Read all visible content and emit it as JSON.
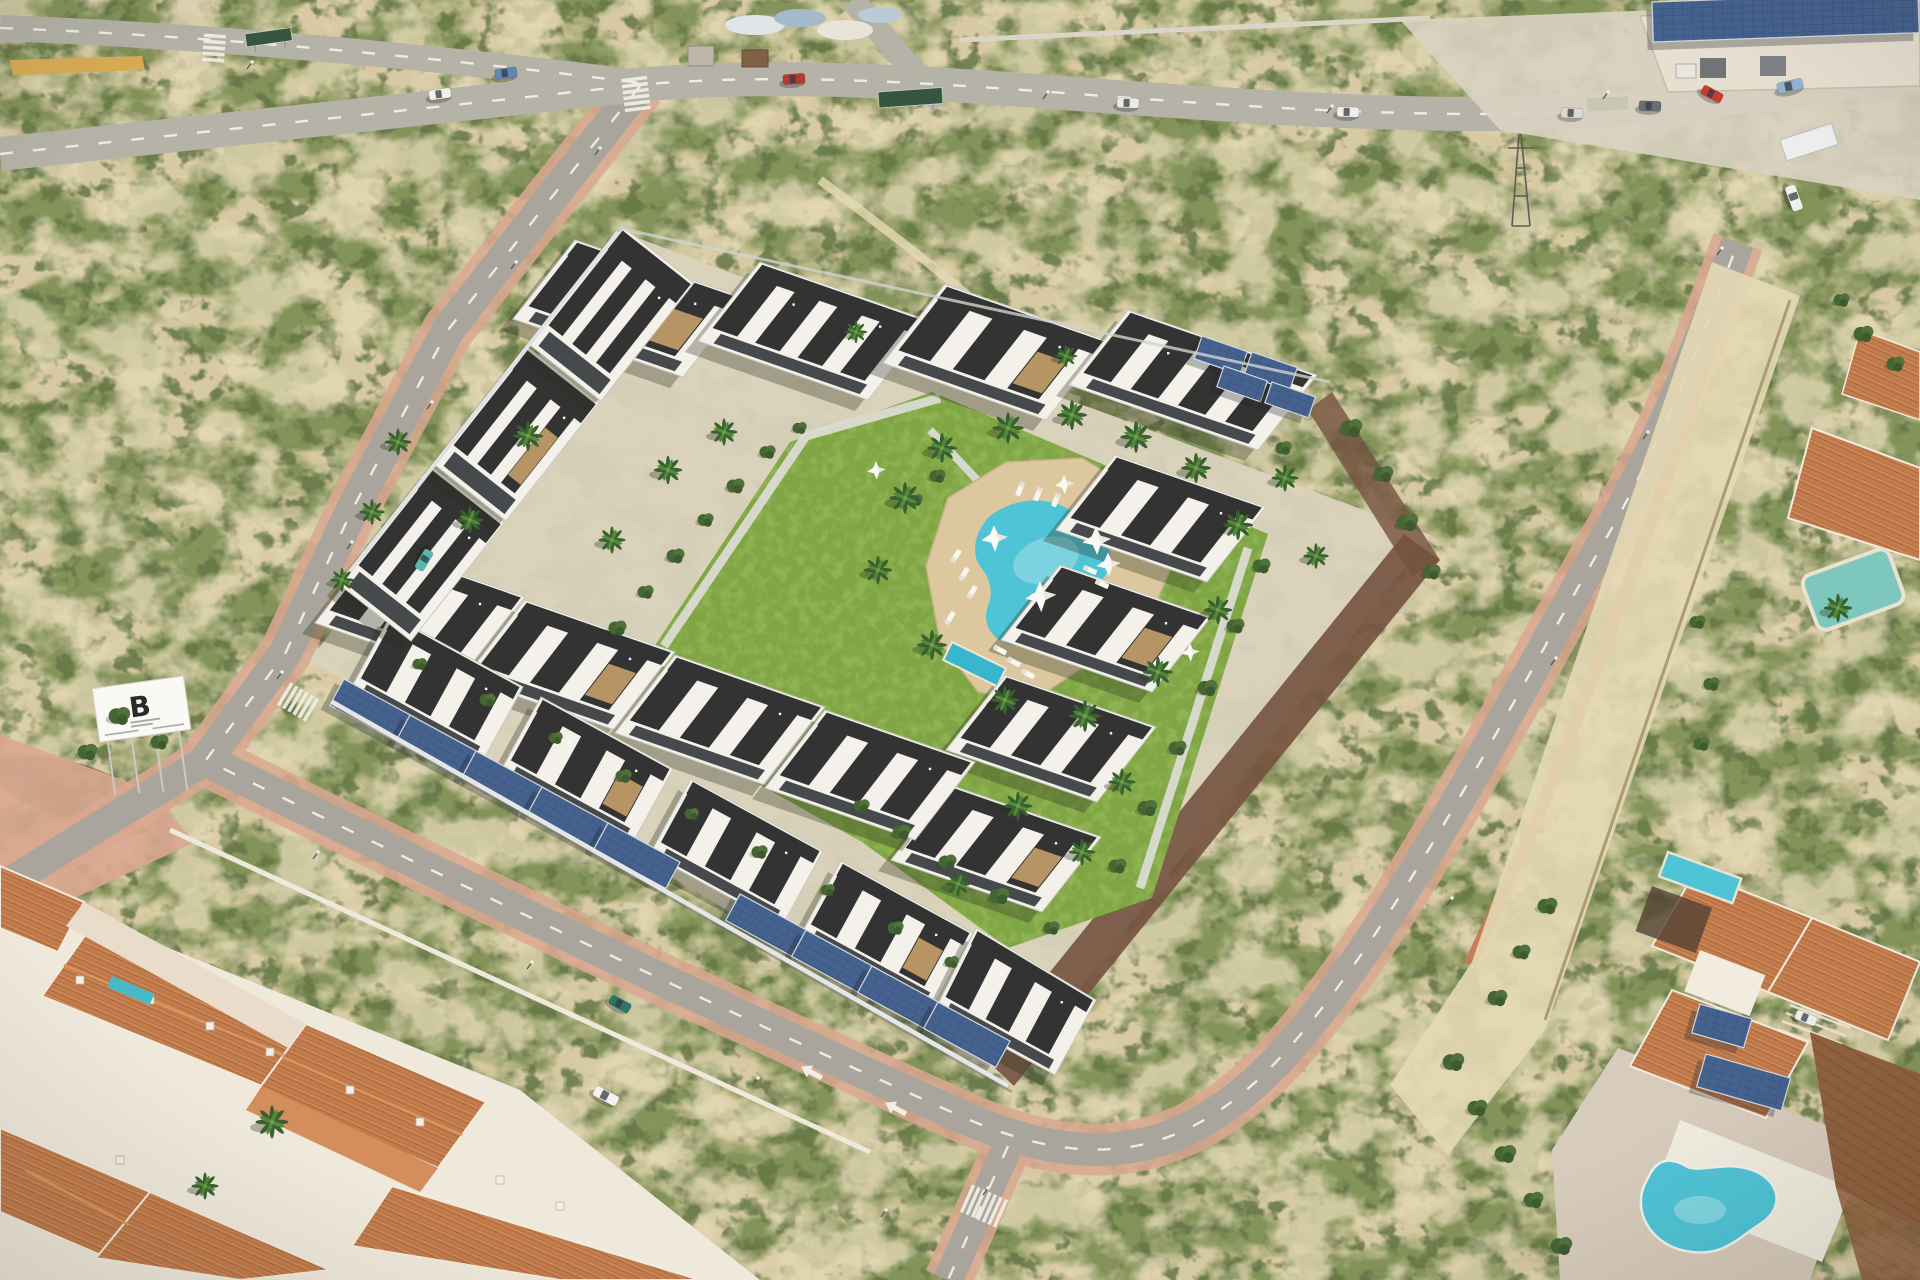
{
  "scene": {
    "description": "Aerial render of a modern white residential complex with central lawn and pool, bordered by roads, scrubland, an older terracotta-roof town and an industrial warehouse"
  },
  "billboard": {
    "letter": "B"
  },
  "palette": {
    "sand": "#d5c8a2",
    "sandLt": "#e3d8b5",
    "scrub": "#7e8f55",
    "scrubD": "#5c7040",
    "lawn": "#7aa23e",
    "lawnLt": "#90b755",
    "road": "#a5a29b",
    "roadLt": "#b2afa7",
    "dash": "#f3f3ee",
    "walk": "#d8a48e",
    "walkRed": "#c4704f",
    "white": "#f3f2ed",
    "wallSh": "#c7c7bf",
    "roof": "#282a2b",
    "glass": "#3d4246",
    "stone": "#b3905e",
    "terra": "#c07747",
    "terraLt": "#d89259",
    "terraD": "#9c5c33",
    "seam": "#8a5a38",
    "solar": "#3c5b8d",
    "solarLn": "#2d4874",
    "frame": "#d3d8de",
    "pool": "#46c2d8",
    "poolLt": "#9ce0ea",
    "poolKid": "#2fb4cf",
    "deck": "#dcc69c",
    "wallGrey": "#e3e6e9",
    "wallMaroon": "#6e4a3a",
    "palmD": "#2e5a28",
    "palmL": "#4d8334",
    "bush": "#3c5e2c",
    "shadow": "rgba(30,36,22,0.32)"
  },
  "complex": {
    "buildings": [
      {
        "pts": [
          [
            575,
            240
          ],
          [
            745,
            298
          ],
          [
            683,
            377
          ],
          [
            513,
            319
          ]
        ],
        "u": 3,
        "a": 1
      },
      {
        "pts": [
          [
            760,
            262
          ],
          [
            930,
            321
          ],
          [
            868,
            400
          ],
          [
            698,
            341
          ]
        ],
        "u": 4
      },
      {
        "pts": [
          [
            945,
            284
          ],
          [
            1108,
            341
          ],
          [
            1046,
            420
          ],
          [
            883,
            363
          ]
        ],
        "u": 3,
        "a": 1
      },
      {
        "pts": [
          [
            1128,
            310
          ],
          [
            1317,
            375
          ],
          [
            1258,
            450
          ],
          [
            1069,
            385
          ]
        ],
        "u": 4
      },
      {
        "pts": [
          [
            1115,
            455
          ],
          [
            1266,
            507
          ],
          [
            1207,
            582
          ],
          [
            1056,
            530
          ]
        ],
        "u": 3
      },
      {
        "pts": [
          [
            1060,
            565
          ],
          [
            1211,
            617
          ],
          [
            1152,
            692
          ],
          [
            1001,
            640
          ]
        ],
        "u": 3,
        "a": 1
      },
      {
        "pts": [
          [
            1005,
            675
          ],
          [
            1156,
            727
          ],
          [
            1097,
            802
          ],
          [
            946,
            750
          ]
        ],
        "u": 3
      },
      {
        "pts": [
          [
            950,
            785
          ],
          [
            1101,
            837
          ],
          [
            1042,
            912
          ],
          [
            891,
            860
          ]
        ],
        "u": 3,
        "a": 1
      },
      {
        "pts": [
          [
            375,
            545
          ],
          [
            525,
            597
          ],
          [
            465,
            675
          ],
          [
            315,
            623
          ]
        ],
        "u": 3
      },
      {
        "pts": [
          [
            525,
            600
          ],
          [
            675,
            652
          ],
          [
            615,
            730
          ],
          [
            465,
            678
          ]
        ],
        "u": 3,
        "a": 1
      },
      {
        "pts": [
          [
            675,
            655
          ],
          [
            825,
            707
          ],
          [
            765,
            785
          ],
          [
            615,
            733
          ]
        ],
        "u": 3
      },
      {
        "pts": [
          [
            825,
            710
          ],
          [
            975,
            762
          ],
          [
            915,
            840
          ],
          [
            765,
            788
          ]
        ],
        "u": 3
      },
      {
        "pts": [
          [
            391,
            615
          ],
          [
            523,
            687
          ],
          [
            482,
            762
          ],
          [
            350,
            690
          ]
        ],
        "u": 3
      },
      {
        "pts": [
          [
            541,
            697
          ],
          [
            673,
            769
          ],
          [
            632,
            844
          ],
          [
            500,
            772
          ]
        ],
        "u": 3,
        "a": 1
      },
      {
        "pts": [
          [
            691,
            779
          ],
          [
            823,
            851
          ],
          [
            782,
            926
          ],
          [
            650,
            854
          ]
        ],
        "u": 3
      },
      {
        "pts": [
          [
            841,
            861
          ],
          [
            973,
            933
          ],
          [
            932,
            1008
          ],
          [
            800,
            936
          ]
        ],
        "u": 3,
        "a": 1
      },
      {
        "pts": [
          [
            976,
            928
          ],
          [
            1096,
            1000
          ],
          [
            1055,
            1075
          ],
          [
            935,
            1010
          ]
        ],
        "u": 3
      },
      {
        "pts": [
          [
            433,
            467
          ],
          [
            504,
            523
          ],
          [
            411,
            641
          ],
          [
            340,
            585
          ]
        ],
        "u": 3
      },
      {
        "pts": [
          [
            528,
            347
          ],
          [
            599,
            403
          ],
          [
            506,
            521
          ],
          [
            435,
            465
          ]
        ],
        "u": 3,
        "a": 1
      },
      {
        "pts": [
          [
            623,
            227
          ],
          [
            694,
            283
          ],
          [
            601,
            401
          ],
          [
            530,
            345
          ]
        ],
        "u": 3
      }
    ],
    "solar_panels": [
      {
        "x": 344,
        "y": 679,
        "w": 82,
        "h": 30,
        "r": 28.5
      },
      {
        "x": 410,
        "y": 715,
        "w": 82,
        "h": 30,
        "r": 28.5
      },
      {
        "x": 476,
        "y": 751,
        "w": 82,
        "h": 30,
        "r": 28.5
      },
      {
        "x": 542,
        "y": 787,
        "w": 82,
        "h": 30,
        "r": 28.5
      },
      {
        "x": 608,
        "y": 823,
        "w": 82,
        "h": 30,
        "r": 28.5
      },
      {
        "x": 740,
        "y": 894,
        "w": 82,
        "h": 30,
        "r": 28.5
      },
      {
        "x": 806,
        "y": 930,
        "w": 82,
        "h": 30,
        "r": 28.5
      },
      {
        "x": 872,
        "y": 966,
        "w": 82,
        "h": 30,
        "r": 28.5
      },
      {
        "x": 938,
        "y": 1002,
        "w": 82,
        "h": 30,
        "r": 28.5
      },
      {
        "x": 1202,
        "y": 336,
        "w": 48,
        "h": 24,
        "r": 19
      },
      {
        "x": 1252,
        "y": 352,
        "w": 48,
        "h": 24,
        "r": 19
      },
      {
        "x": 1224,
        "y": 366,
        "w": 46,
        "h": 22,
        "r": 19
      },
      {
        "x": 1272,
        "y": 382,
        "w": 46,
        "h": 22,
        "r": 19
      },
      {
        "x": 1652,
        "y": 2,
        "w": 266,
        "h": 40,
        "r": -2
      },
      {
        "x": 1700,
        "y": 1004,
        "w": 54,
        "h": 30,
        "r": 16
      },
      {
        "x": 1706,
        "y": 1054,
        "w": 88,
        "h": 34,
        "r": 16
      }
    ]
  },
  "vegetation": {
    "palms": [
      {
        "x": 398,
        "y": 442,
        "s": 0.9
      },
      {
        "x": 372,
        "y": 512,
        "s": 0.85
      },
      {
        "x": 342,
        "y": 580,
        "s": 0.8
      },
      {
        "x": 528,
        "y": 436,
        "s": 1.0
      },
      {
        "x": 470,
        "y": 520,
        "s": 0.9
      },
      {
        "x": 668,
        "y": 470,
        "s": 0.95
      },
      {
        "x": 612,
        "y": 540,
        "s": 0.9
      },
      {
        "x": 724,
        "y": 432,
        "s": 0.9
      },
      {
        "x": 856,
        "y": 332,
        "s": 0.75
      },
      {
        "x": 1066,
        "y": 356,
        "s": 0.75
      },
      {
        "x": 905,
        "y": 498,
        "s": 1.05
      },
      {
        "x": 942,
        "y": 448,
        "s": 1.0
      },
      {
        "x": 1008,
        "y": 428,
        "s": 1.05
      },
      {
        "x": 1072,
        "y": 415,
        "s": 1.0
      },
      {
        "x": 1136,
        "y": 437,
        "s": 1.05
      },
      {
        "x": 1196,
        "y": 468,
        "s": 1.0
      },
      {
        "x": 1238,
        "y": 525,
        "s": 1.0
      },
      {
        "x": 1218,
        "y": 610,
        "s": 0.95
      },
      {
        "x": 1158,
        "y": 672,
        "s": 1.0
      },
      {
        "x": 1085,
        "y": 716,
        "s": 1.05
      },
      {
        "x": 1005,
        "y": 700,
        "s": 0.95
      },
      {
        "x": 932,
        "y": 645,
        "s": 1.0
      },
      {
        "x": 878,
        "y": 570,
        "s": 0.95
      },
      {
        "x": 1285,
        "y": 478,
        "s": 0.9
      },
      {
        "x": 1316,
        "y": 556,
        "s": 0.85
      },
      {
        "x": 1018,
        "y": 806,
        "s": 0.95
      },
      {
        "x": 1082,
        "y": 852,
        "s": 0.9
      },
      {
        "x": 958,
        "y": 884,
        "s": 0.85
      },
      {
        "x": 1122,
        "y": 782,
        "s": 0.9
      },
      {
        "x": 272,
        "y": 1122,
        "s": 1.1
      },
      {
        "x": 205,
        "y": 1186,
        "s": 0.9
      },
      {
        "x": 1838,
        "y": 608,
        "s": 0.95
      }
    ],
    "bushes": [
      {
        "x": 618,
        "y": 628,
        "s": 1
      },
      {
        "x": 646,
        "y": 592,
        "s": 0.9
      },
      {
        "x": 676,
        "y": 556,
        "s": 1
      },
      {
        "x": 706,
        "y": 520,
        "s": 0.9
      },
      {
        "x": 736,
        "y": 486,
        "s": 1
      },
      {
        "x": 768,
        "y": 452,
        "s": 0.9
      },
      {
        "x": 800,
        "y": 428,
        "s": 0.8
      },
      {
        "x": 938,
        "y": 476,
        "s": 0.9
      },
      {
        "x": 916,
        "y": 500,
        "s": 0.8
      },
      {
        "x": 1262,
        "y": 566,
        "s": 1
      },
      {
        "x": 1236,
        "y": 626,
        "s": 1
      },
      {
        "x": 1208,
        "y": 688,
        "s": 1.1
      },
      {
        "x": 1178,
        "y": 748,
        "s": 1
      },
      {
        "x": 1148,
        "y": 808,
        "s": 1.1
      },
      {
        "x": 1118,
        "y": 866,
        "s": 1
      },
      {
        "x": 862,
        "y": 806,
        "s": 0.9
      },
      {
        "x": 902,
        "y": 832,
        "s": 1
      },
      {
        "x": 948,
        "y": 862,
        "s": 1
      },
      {
        "x": 1000,
        "y": 896,
        "s": 1.1
      },
      {
        "x": 1052,
        "y": 928,
        "s": 0.9
      },
      {
        "x": 420,
        "y": 664,
        "s": 0.8
      },
      {
        "x": 488,
        "y": 700,
        "s": 0.9
      },
      {
        "x": 556,
        "y": 738,
        "s": 0.8
      },
      {
        "x": 624,
        "y": 776,
        "s": 0.9
      },
      {
        "x": 692,
        "y": 814,
        "s": 0.8
      },
      {
        "x": 760,
        "y": 852,
        "s": 0.9
      },
      {
        "x": 828,
        "y": 890,
        "s": 0.8
      },
      {
        "x": 896,
        "y": 928,
        "s": 0.9
      },
      {
        "x": 952,
        "y": 962,
        "s": 0.8
      },
      {
        "x": 1352,
        "y": 428,
        "s": 1.2
      },
      {
        "x": 1384,
        "y": 474,
        "s": 1.1
      },
      {
        "x": 1408,
        "y": 522,
        "s": 1.2
      },
      {
        "x": 1284,
        "y": 448,
        "s": 0.9
      },
      {
        "x": 1432,
        "y": 572,
        "s": 1
      },
      {
        "x": 1548,
        "y": 906,
        "s": 1.1
      },
      {
        "x": 1522,
        "y": 952,
        "s": 1
      },
      {
        "x": 1498,
        "y": 998,
        "s": 1.1
      },
      {
        "x": 1454,
        "y": 1062,
        "s": 1.2
      },
      {
        "x": 1478,
        "y": 1108,
        "s": 1.1
      },
      {
        "x": 1506,
        "y": 1154,
        "s": 1.2
      },
      {
        "x": 1534,
        "y": 1200,
        "s": 1.1
      },
      {
        "x": 1562,
        "y": 1246,
        "s": 1.2
      },
      {
        "x": 1698,
        "y": 622,
        "s": 0.9
      },
      {
        "x": 1712,
        "y": 684,
        "s": 0.9
      },
      {
        "x": 1702,
        "y": 744,
        "s": 0.9
      },
      {
        "x": 120,
        "y": 716,
        "s": 1.2
      },
      {
        "x": 88,
        "y": 752,
        "s": 1.1
      },
      {
        "x": 160,
        "y": 742,
        "s": 1
      },
      {
        "x": 1864,
        "y": 334,
        "s": 1.1
      },
      {
        "x": 1896,
        "y": 364,
        "s": 1
      },
      {
        "x": 1842,
        "y": 300,
        "s": 0.9
      }
    ]
  },
  "pool_area": {
    "loungers": [
      {
        "x": 956,
        "y": 556,
        "r": -58
      },
      {
        "x": 964,
        "y": 574,
        "r": -58
      },
      {
        "x": 972,
        "y": 592,
        "r": -58
      },
      {
        "x": 950,
        "y": 618,
        "r": -58
      },
      {
        "x": 1090,
        "y": 570,
        "r": 24
      },
      {
        "x": 1102,
        "y": 584,
        "r": 24
      },
      {
        "x": 1020,
        "y": 489,
        "r": 112
      },
      {
        "x": 1038,
        "y": 494,
        "r": 112
      },
      {
        "x": 1056,
        "y": 500,
        "r": 112
      },
      {
        "x": 1000,
        "y": 650,
        "r": 28
      },
      {
        "x": 1014,
        "y": 662,
        "r": 28
      },
      {
        "x": 1028,
        "y": 674,
        "r": 28
      }
    ],
    "sails": [
      {
        "x": 994,
        "y": 538,
        "s": 1.15
      },
      {
        "x": 1096,
        "y": 540,
        "s": 1.25
      },
      {
        "x": 1108,
        "y": 564,
        "s": 1.05
      },
      {
        "x": 1040,
        "y": 596,
        "s": 1.35
      },
      {
        "x": 1064,
        "y": 484,
        "s": 0.85
      },
      {
        "x": 876,
        "y": 470,
        "s": 0.8
      },
      {
        "x": 1190,
        "y": 652,
        "s": 0.8
      }
    ]
  },
  "traffic": {
    "cars": [
      {
        "x": 440,
        "y": 94,
        "r": -8,
        "c": "#f2f2ef",
        "t": "car"
      },
      {
        "x": 506,
        "y": 73,
        "r": -8,
        "c": "#5b82b4",
        "t": "car"
      },
      {
        "x": 794,
        "y": 79,
        "r": -4,
        "c": "#b23227",
        "t": "car"
      },
      {
        "x": 1128,
        "y": 103,
        "r": 2,
        "c": "#eceae6",
        "t": "car"
      },
      {
        "x": 1348,
        "y": 112,
        "r": 2,
        "c": "#f0efec",
        "t": "car"
      },
      {
        "x": 1572,
        "y": 113,
        "r": 2,
        "c": "#d8d7d2",
        "t": "car"
      },
      {
        "x": 1650,
        "y": 106,
        "r": 2,
        "c": "#63686e",
        "t": "car"
      },
      {
        "x": 1790,
        "y": 86,
        "r": -12,
        "c": "#8fb2d2",
        "t": "van"
      },
      {
        "x": 1712,
        "y": 94,
        "r": 28,
        "c": "#c03528",
        "t": "car"
      },
      {
        "x": 424,
        "y": 560,
        "r": 121,
        "c": "#4fb6ae",
        "t": "car"
      },
      {
        "x": 620,
        "y": 1004,
        "r": 28,
        "c": "#1f6f66",
        "t": "car"
      },
      {
        "x": 606,
        "y": 1096,
        "r": 28,
        "c": "#f4f3ef",
        "t": "van"
      },
      {
        "x": 1794,
        "y": 198,
        "r": 70,
        "c": "#f2f1ed",
        "t": "van"
      },
      {
        "x": 1806,
        "y": 1018,
        "r": 22,
        "c": "#eeede9",
        "t": "car"
      }
    ],
    "crosswalks": [
      {
        "x": 636,
        "y": 94,
        "r": -7,
        "n": 6,
        "len": 26
      },
      {
        "x": 214,
        "y": 48,
        "r": 4,
        "n": 5,
        "len": 22
      },
      {
        "x": 298,
        "y": 702,
        "r": 121,
        "n": 6,
        "len": 26
      },
      {
        "x": 984,
        "y": 1206,
        "r": 114,
        "n": 7,
        "len": 30
      }
    ],
    "arrows": [
      {
        "x": 822,
        "y": 1078,
        "r": 208.5
      },
      {
        "x": 906,
        "y": 1114,
        "r": 208.5
      }
    ],
    "streetlights": [
      {
        "x": 600,
        "y": 148
      },
      {
        "x": 516,
        "y": 262
      },
      {
        "x": 432,
        "y": 402
      },
      {
        "x": 352,
        "y": 542
      },
      {
        "x": 282,
        "y": 672
      },
      {
        "x": 318,
        "y": 852
      },
      {
        "x": 532,
        "y": 962
      },
      {
        "x": 758,
        "y": 1078
      },
      {
        "x": 988,
        "y": 1188
      },
      {
        "x": 1452,
        "y": 898
      },
      {
        "x": 1556,
        "y": 658
      },
      {
        "x": 1648,
        "y": 432
      },
      {
        "x": 1722,
        "y": 248
      },
      {
        "x": 1048,
        "y": 92
      },
      {
        "x": 1332,
        "y": 106
      },
      {
        "x": 1608,
        "y": 92
      },
      {
        "x": 252,
        "y": 62
      },
      {
        "x": 886,
        "y": 1210
      }
    ]
  }
}
